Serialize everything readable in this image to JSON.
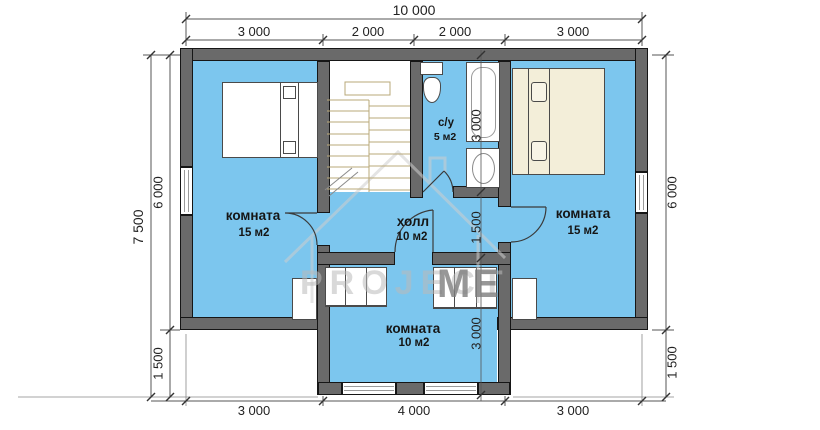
{
  "plan": {
    "rooms": {
      "left": {
        "label": "комната",
        "area": "15 м2"
      },
      "hall": {
        "label": "холл",
        "area": "10 м2"
      },
      "bath": {
        "label": "с/у",
        "area": "5 м2"
      },
      "right": {
        "label": "комната",
        "area": "15 м2"
      },
      "bottom": {
        "label": "комната",
        "area": "10 м2"
      }
    },
    "dims": {
      "top_total": "10 000",
      "top": [
        "3 000",
        "2 000",
        "2 000",
        "3 000"
      ],
      "left_total": "7 500",
      "left": [
        "6 000",
        "1 500"
      ],
      "right": [
        "6 000",
        "1 500"
      ],
      "bottom": [
        "3 000",
        "4 000",
        "3 000"
      ],
      "inner": [
        "3 000",
        "1 500",
        "3 000"
      ]
    },
    "watermark": {
      "left": "PROJECT",
      "right": "ME"
    },
    "colors": {
      "room_fill": "#7cc6ee",
      "wall": "#6a6a6a",
      "bed_cream": "#f3eed9",
      "stair_line": "#b9a878"
    }
  }
}
